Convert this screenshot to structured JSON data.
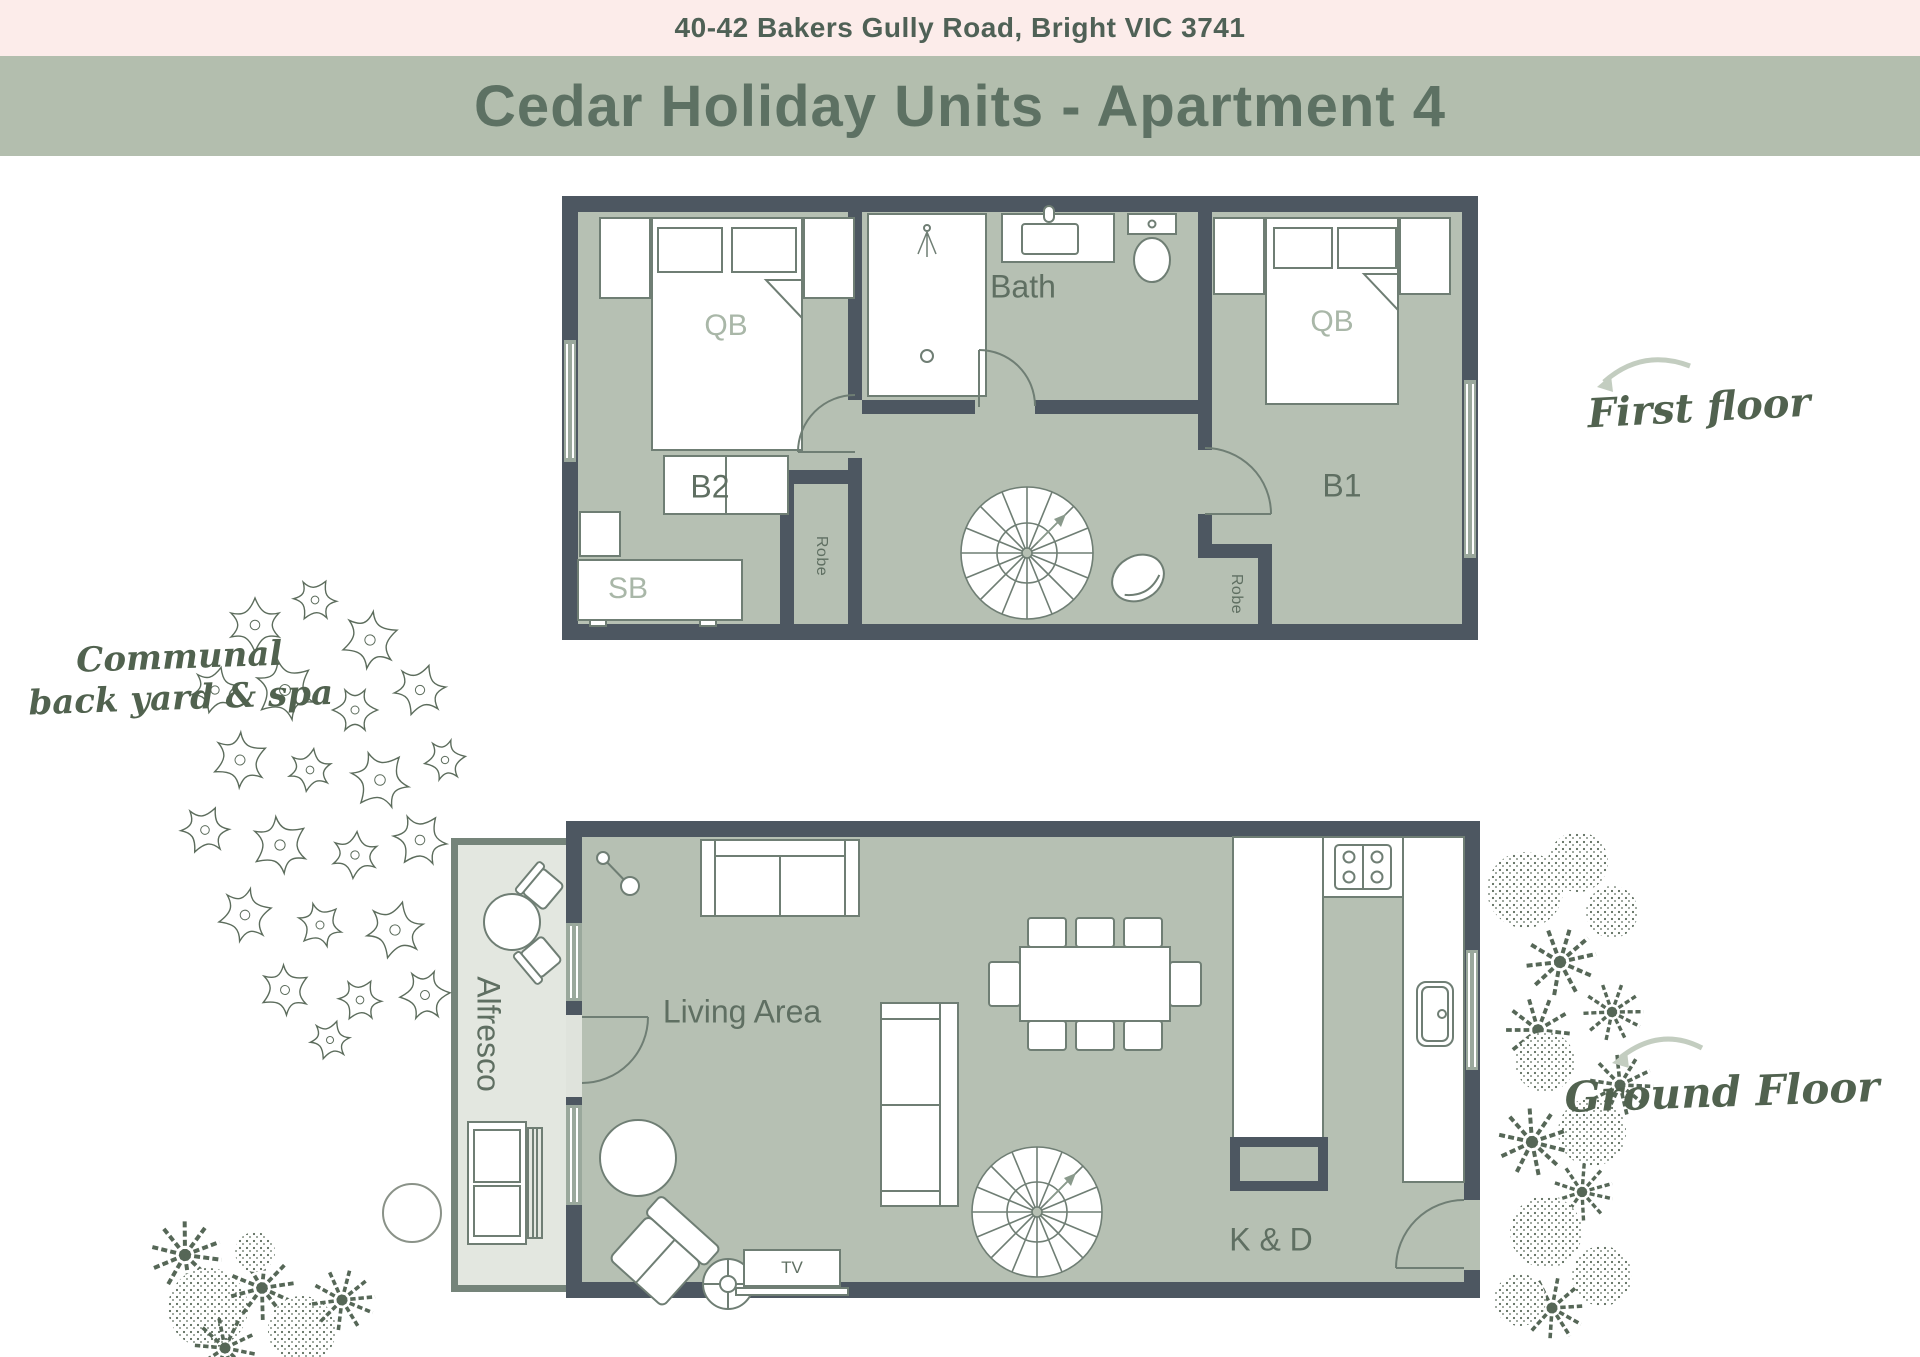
{
  "header": {
    "address": "40-42 Bakers Gully Road, Bright VIC 3741",
    "title": "Cedar Holiday Units - Apartment 4"
  },
  "first_floor": {
    "label_b2": "B2",
    "label_bath": "Bath",
    "label_b1": "B1",
    "label_qb_b2": "QB",
    "label_qb_b1": "QB",
    "label_sb": "SB",
    "label_robe_left": "Robe",
    "label_robe_right": "Robe",
    "annotation": "First floor"
  },
  "ground_floor": {
    "label_living": "Living Area",
    "label_alfresco": "Alfresco",
    "label_kd": "K & D",
    "label_tv": "TV",
    "annotation": "Ground Floor"
  },
  "yard_note": {
    "line1": "Communal",
    "line2": "back yard & spa"
  },
  "colors": {
    "address_bar_bg": "#fcecea",
    "title_bar_bg": "#b3beae",
    "title_text": "#5d7163",
    "wall": "#4d5761",
    "floor": "#b6c0b3",
    "alfresco_floor": "#e3e7e0",
    "alfresco_wall": "#75847a",
    "furniture_outline": "#6f7e74",
    "window": "#9aa89c",
    "room_label": "#5f6f62",
    "bed_label": "#a9b7a8",
    "script_label": "#51624f",
    "arrow": "#c3cdc0",
    "plant": "#5c6c5c"
  }
}
